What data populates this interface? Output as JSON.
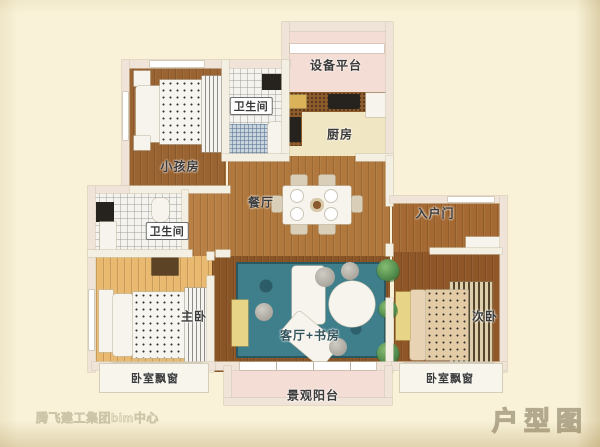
{
  "title": {
    "label": "户型图"
  },
  "watermark": {
    "text": "腾飞建工集团bim中心"
  },
  "rooms": {
    "equipment_platform": {
      "label": "设备平台"
    },
    "bathroom_top": {
      "label": "卫生间"
    },
    "kitchen": {
      "label": "厨房"
    },
    "kids_room": {
      "label": "小孩房"
    },
    "dining": {
      "label": "餐厅"
    },
    "entrance": {
      "label": "入户门"
    },
    "bathroom_left": {
      "label": "卫生间"
    },
    "master_bedroom": {
      "label": "主卧"
    },
    "living_study": {
      "label": "客厅+书房"
    },
    "second_bedroom": {
      "label": "次卧"
    },
    "balcony": {
      "label": "景观阳台"
    },
    "bay_window_left": {
      "label": "卧室飘窗"
    },
    "bay_window_right": {
      "label": "卧室飘窗"
    }
  },
  "colors": {
    "background": "#f9f2d8",
    "wall_interior": "#f4efe3",
    "wall_exterior": "#f0e4d9",
    "wood_kids_room": "#9a6432",
    "wood_dining": "#b0783c",
    "wood_hall": "#b98046",
    "wood_entrance": "#a56a33",
    "wood_master": "#e9b96f",
    "wood_living": "#8a5526",
    "wood_second": "#8f5627",
    "rug_teal": "#3f7e8b",
    "balcony_pink": "#f3ddd4",
    "kitchen_floor": "#f0e6c4",
    "counter_cork": "#8d5a2c",
    "desk_yellow": "#e7d487",
    "title_gray": "#b3a98e"
  }
}
